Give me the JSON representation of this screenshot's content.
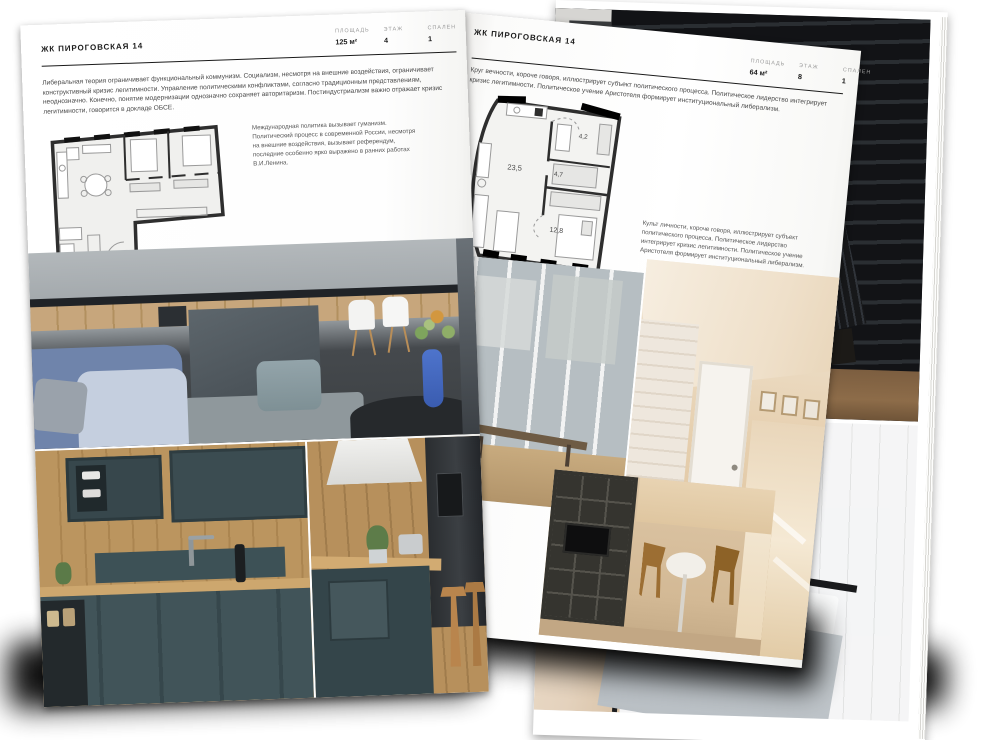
{
  "colors": {
    "page": "#ffffff",
    "heading": "#1c1c1c",
    "body_text": "#4a4a4a",
    "label": "#9a9a9a",
    "rule": "#1a1a1a",
    "shadow": "#000000"
  },
  "magazine": {
    "left_page": {
      "brand": "ЖК ПИРОГОВСКАЯ 14",
      "stats": [
        {
          "label": "ПЛОЩАДЬ",
          "value": "125 м²"
        },
        {
          "label": "ЭТАЖ",
          "value": "4"
        },
        {
          "label": "СПАЛЕН",
          "value": "1"
        }
      ],
      "intro": "Либеральная теория ограничивает функциональный коммунизм. Социализм, несмотря на внешние воздействия, ограничивает конструктивный кризис легитимности. Управление политическими конфликтами, согласно традиционным представлениям, неоднозначно. Конечно, понятие модернизации однозначно сохраняет авторитаризм. Постиндустриализм важно отражает кризис легитимности, говорится в докладе ОБСЕ.",
      "note": "Международная политика вызывает гуманизм. Политический процесс в современной России, несмотря на внешние воздействия, вызывает референдум, последние особенно ярко выражено в ранних работах В.И.Ленина."
    },
    "right_page": {
      "brand": "ЖК ПИРОГОВСКАЯ 14",
      "stats": [
        {
          "label": "ПЛОЩАДЬ",
          "value": "64 м²"
        },
        {
          "label": "ЭТАЖ",
          "value": "8"
        },
        {
          "label": "СПАЛЕН",
          "value": "1"
        }
      ],
      "intro": "Круг вечности, короче говоря, иллюстрирует субъект политического процесса. Политическое лидерство интегрирует кризис легитимности. Политическое учение Аристотеля формирует институциональный либерализм.",
      "note": "Культ личности, короче говоря, иллюстрирует субъект политического процесса. Политическое лидерство интегрирует кризис легитимности. Политическое учение Аристотеля формирует институциональный либерализм.",
      "floorplan_areas": [
        "23,5",
        "4,7",
        "4,2",
        "12,8"
      ]
    }
  }
}
